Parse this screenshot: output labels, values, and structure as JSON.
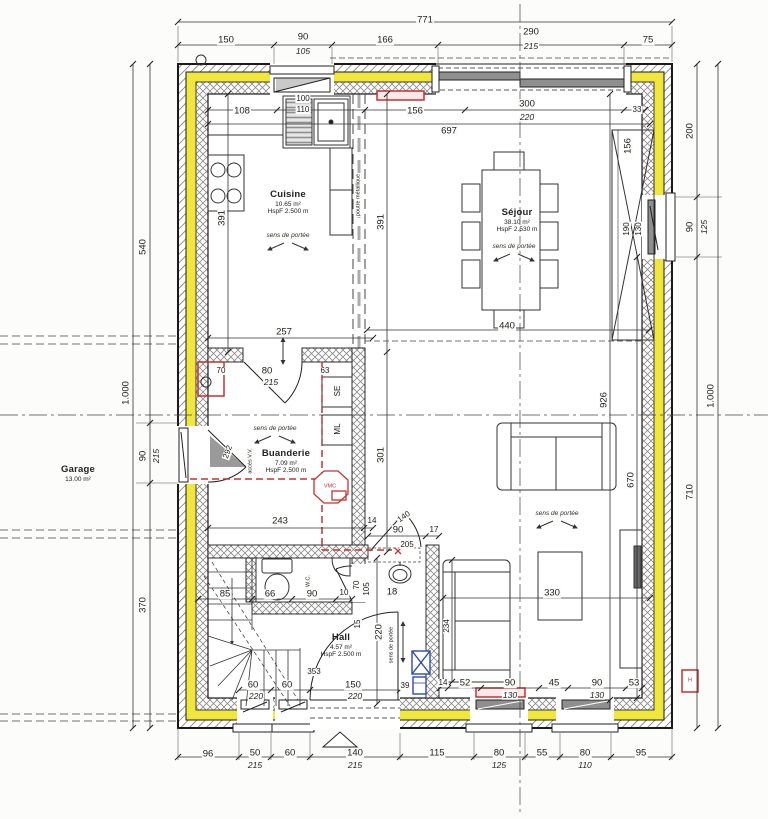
{
  "title": "Plan rez-de-chaussée",
  "colors": {
    "insulation": "#f0e63c",
    "wall_line": "#1a1a1a",
    "accent_red": "#c23333",
    "accent_blue": "#2f4ba8"
  },
  "rooms": [
    {
      "id": "cuisine",
      "name": "Cuisine",
      "area": "10.65 m²",
      "height": "HspF 2.500 m",
      "x": 288,
      "y": 203
    },
    {
      "id": "sejour",
      "name": "Séjour",
      "area": "38.10 m²",
      "height": "HspF 2.530 m",
      "x": 517,
      "y": 221
    },
    {
      "id": "buanderie",
      "name": "Buanderie",
      "area": "7.09 m²",
      "height": "HspF 2.500 m",
      "x": 286,
      "y": 462
    },
    {
      "id": "hall",
      "name": "Hall",
      "area": "4.57 m²",
      "height": "HspF 2.500 m",
      "x": 341,
      "y": 646
    },
    {
      "id": "garage",
      "name": "Garage",
      "area": "13.00 m²",
      "height": "",
      "x": 78,
      "y": 474
    }
  ],
  "dim_labels": [
    {
      "t": "771",
      "x": 425,
      "y": 20
    },
    {
      "t": "150",
      "x": 226,
      "y": 40
    },
    {
      "t": "90",
      "x": 303,
      "y": 37
    },
    {
      "t": "105",
      "x": 303,
      "y": 51,
      "c": "i"
    },
    {
      "t": "166",
      "x": 385,
      "y": 40
    },
    {
      "t": "290",
      "x": 531,
      "y": 32
    },
    {
      "t": "215",
      "x": 531,
      "y": 46,
      "c": "i"
    },
    {
      "t": "75",
      "x": 648,
      "y": 40
    },
    {
      "t": "108",
      "x": 242,
      "y": 111
    },
    {
      "t": "100",
      "x": 303,
      "y": 99,
      "c": "s"
    },
    {
      "t": "110",
      "x": 303,
      "y": 110,
      "c": "s"
    },
    {
      "t": "156",
      "x": 415,
      "y": 111
    },
    {
      "t": "300",
      "x": 527,
      "y": 104
    },
    {
      "t": "220",
      "x": 527,
      "y": 117,
      "c": "i"
    },
    {
      "t": "33",
      "x": 637,
      "y": 110,
      "c": "s"
    },
    {
      "t": "697",
      "x": 449,
      "y": 131
    },
    {
      "t": "200",
      "x": 690,
      "y": 131,
      "r": -90
    },
    {
      "t": "156",
      "x": 628,
      "y": 146,
      "r": -90
    },
    {
      "t": "190",
      "x": 627,
      "y": 229,
      "r": -90,
      "c": "s"
    },
    {
      "t": "130",
      "x": 639,
      "y": 229,
      "r": -90,
      "c": "s"
    },
    {
      "t": "90",
      "x": 690,
      "y": 227,
      "r": -90
    },
    {
      "t": "125",
      "x": 704,
      "y": 227,
      "r": -90,
      "c": "i"
    },
    {
      "t": "1.000",
      "x": 711,
      "y": 396,
      "r": -90
    },
    {
      "t": "710",
      "x": 690,
      "y": 492,
      "r": -90
    },
    {
      "t": "540",
      "x": 143,
      "y": 247,
      "r": -90
    },
    {
      "t": "1.000",
      "x": 126,
      "y": 393,
      "r": -90
    },
    {
      "t": "90",
      "x": 143,
      "y": 456,
      "r": -90
    },
    {
      "t": "215",
      "x": 156,
      "y": 456,
      "r": -90,
      "c": "i"
    },
    {
      "t": "370",
      "x": 143,
      "y": 605,
      "r": -90
    },
    {
      "t": "391",
      "x": 222,
      "y": 218,
      "r": -90
    },
    {
      "t": "391",
      "x": 381,
      "y": 222,
      "r": -90
    },
    {
      "t": "440",
      "x": 507,
      "y": 326
    },
    {
      "t": "926",
      "x": 604,
      "y": 400,
      "r": -90
    },
    {
      "t": "670",
      "x": 631,
      "y": 480,
      "r": -90
    },
    {
      "t": "330",
      "x": 552,
      "y": 593
    },
    {
      "t": "234",
      "x": 447,
      "y": 626,
      "r": -90,
      "c": "s"
    },
    {
      "t": "14",
      "x": 443,
      "y": 683,
      "c": "s"
    },
    {
      "t": "52",
      "x": 465,
      "y": 683
    },
    {
      "t": "90",
      "x": 510,
      "y": 683
    },
    {
      "t": "130",
      "x": 510,
      "y": 695,
      "c": "i"
    },
    {
      "t": "45",
      "x": 554,
      "y": 683
    },
    {
      "t": "90",
      "x": 597,
      "y": 683
    },
    {
      "t": "130",
      "x": 597,
      "y": 695,
      "c": "i"
    },
    {
      "t": "53",
      "x": 634,
      "y": 683
    },
    {
      "t": "70",
      "x": 221,
      "y": 371,
      "c": "s"
    },
    {
      "t": "80",
      "x": 267,
      "y": 371
    },
    {
      "t": "215",
      "x": 271,
      "y": 382,
      "c": "i"
    },
    {
      "t": "63",
      "x": 325,
      "y": 371,
      "c": "s"
    },
    {
      "t": "257",
      "x": 284,
      "y": 332
    },
    {
      "t": "292",
      "x": 228,
      "y": 452,
      "r": -70,
      "c": "s"
    },
    {
      "t": "243",
      "x": 280,
      "y": 521
    },
    {
      "t": "14",
      "x": 372,
      "y": 521,
      "c": "s"
    },
    {
      "t": "140",
      "x": 404,
      "y": 517,
      "r": -35,
      "c": "s"
    },
    {
      "t": "301",
      "x": 381,
      "y": 455,
      "r": -90
    },
    {
      "t": "90",
      "x": 398,
      "y": 530
    },
    {
      "t": "205",
      "x": 407,
      "y": 545,
      "c": "s"
    },
    {
      "t": "17",
      "x": 434,
      "y": 530,
      "c": "s"
    },
    {
      "t": "85",
      "x": 225,
      "y": 594
    },
    {
      "t": "66",
      "x": 270,
      "y": 594
    },
    {
      "t": "90",
      "x": 312,
      "y": 594
    },
    {
      "t": "10",
      "x": 344,
      "y": 593,
      "c": "s"
    },
    {
      "t": "70",
      "x": 357,
      "y": 585,
      "r": -90,
      "c": "s"
    },
    {
      "t": "105",
      "x": 367,
      "y": 589,
      "r": -90,
      "c": "s"
    },
    {
      "t": "18",
      "x": 392,
      "y": 592
    },
    {
      "t": "15",
      "x": 358,
      "y": 624,
      "r": -90,
      "c": "s"
    },
    {
      "t": "220",
      "x": 379,
      "y": 632,
      "r": -90
    },
    {
      "t": "353",
      "x": 314,
      "y": 672,
      "c": "s"
    },
    {
      "t": "39",
      "x": 405,
      "y": 686,
      "c": "s"
    },
    {
      "t": "60",
      "x": 253,
      "y": 685
    },
    {
      "t": "220",
      "x": 256,
      "y": 696,
      "c": "i"
    },
    {
      "t": "60",
      "x": 287,
      "y": 685
    },
    {
      "t": "150",
      "x": 353,
      "y": 685
    },
    {
      "t": "220",
      "x": 355,
      "y": 696,
      "c": "i"
    },
    {
      "t": "96",
      "x": 208,
      "y": 754
    },
    {
      "t": "50",
      "x": 255,
      "y": 753
    },
    {
      "t": "215",
      "x": 255,
      "y": 765,
      "c": "i"
    },
    {
      "t": "60",
      "x": 290,
      "y": 753
    },
    {
      "t": "140",
      "x": 355,
      "y": 753
    },
    {
      "t": "215",
      "x": 355,
      "y": 765,
      "c": "i"
    },
    {
      "t": "115",
      "x": 437,
      "y": 753
    },
    {
      "t": "80",
      "x": 499,
      "y": 753
    },
    {
      "t": "125",
      "x": 499,
      "y": 765,
      "c": "i"
    },
    {
      "t": "55",
      "x": 542,
      "y": 753
    },
    {
      "t": "80",
      "x": 585,
      "y": 753
    },
    {
      "t": "110",
      "x": 585,
      "y": 765,
      "c": "i"
    },
    {
      "t": "95",
      "x": 641,
      "y": 753
    }
  ],
  "annotations": [
    {
      "t": "sens de portée",
      "x": 288,
      "y": 236,
      "c": "n"
    },
    {
      "t": "sens de portée",
      "x": 514,
      "y": 247,
      "c": "n"
    },
    {
      "t": "sens de portée",
      "x": 275,
      "y": 429,
      "c": "n"
    },
    {
      "t": "sens de portée",
      "x": 557,
      "y": 514,
      "c": "n"
    },
    {
      "t": "sens de portée",
      "x": 392,
      "y": 645,
      "r": -90,
      "c": "t"
    },
    {
      "t": "poutre métallique",
      "x": 359,
      "y": 195,
      "r": -90,
      "c": "t"
    },
    {
      "t": "accès V.V.",
      "x": 251,
      "y": 461,
      "r": -90,
      "c": "t"
    },
    {
      "t": "W.C.",
      "x": 309,
      "y": 581,
      "r": -90,
      "c": "t"
    },
    {
      "t": "SE",
      "x": 338,
      "y": 391,
      "r": -90,
      "c": "s"
    },
    {
      "t": "ML",
      "x": 338,
      "y": 429,
      "r": -90,
      "c": "s"
    },
    {
      "t": "VMC",
      "x": 330,
      "y": 487,
      "c": "t red"
    },
    {
      "t": "H",
      "x": 690,
      "y": 681,
      "c": "t red"
    }
  ]
}
